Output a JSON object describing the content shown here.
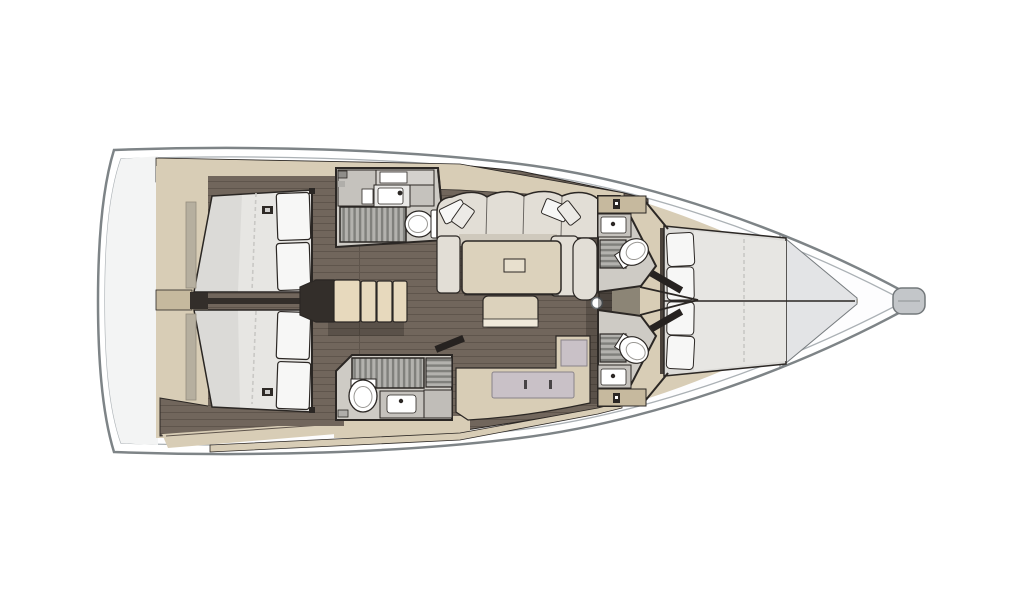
{
  "meta": {
    "title": "Sailing yacht interior layout plan, top view, bow to the right",
    "orientation": "bow-right"
  },
  "colors": {
    "page-bg": "#ffffff",
    "hull-line": "#7e8487",
    "hull-inner": "#abb1b5",
    "deck": "#fdfdfe",
    "stern": "#f3f4f4",
    "beige": "#d8cdb6",
    "beige-dark": "#c6b99e",
    "cream": "#e7d9bd",
    "wood": "#71665c",
    "wood-line": "#5f554c",
    "wall-dark": "#332e2a",
    "door-dark": "#262220",
    "outline": "#2b2724",
    "shadow": "rgba(0,0,0,0.20)",
    "mattress": "#e7e6e3",
    "mattress-edge": "#c9c8c5",
    "pillow": "#f7f7f6",
    "sofa": "#e2ded6",
    "sofa-shade": "#cfc9bd",
    "table": "#dcd2bc",
    "fixture-floor": "#cecbc5",
    "counter": "#c5c2bd",
    "grate": "#b3b2ae",
    "grate-slat": "#80807c",
    "white": "#ffffff",
    "mauve": "#c9c1c7",
    "bow-wedge": "#e3e4e6",
    "metal": "#c3c6c9"
  },
  "vessel": {
    "rooms": [
      {
        "id": "stern-locker",
        "fixtures": []
      },
      {
        "id": "aft-cabin-port",
        "fixtures": [
          "double-berth",
          "pillow",
          "pillow",
          "hanging-locker",
          "reading-light",
          "wardrobe"
        ]
      },
      {
        "id": "aft-cabin-starboard",
        "fixtures": [
          "double-berth",
          "pillow",
          "pillow",
          "hanging-locker",
          "reading-light",
          "wardrobe"
        ]
      },
      {
        "id": "head-aft-port",
        "fixtures": [
          "vanity-counter",
          "washbasin",
          "shower-grating",
          "toilet"
        ]
      },
      {
        "id": "head-aft-starboard",
        "fixtures": [
          "shower-grating",
          "toilet",
          "washbasin",
          "locker"
        ]
      },
      {
        "id": "companionway",
        "fixtures": [
          "landing",
          "step",
          "step",
          "step",
          "step"
        ]
      },
      {
        "id": "salon",
        "fixtures": [
          "u-sofa",
          "throw-pillow",
          "throw-pillow",
          "throw-pillow",
          "throw-pillow",
          "saloon-table",
          "table-hatch",
          "ottoman",
          "sideboard"
        ]
      },
      {
        "id": "mast-post",
        "fixtures": []
      },
      {
        "id": "head-forward-port",
        "fixtures": [
          "cabinet",
          "washbasin",
          "shower-grating",
          "toilet"
        ]
      },
      {
        "id": "head-forward-starboard",
        "fixtures": [
          "cabinet",
          "washbasin",
          "shower-grating",
          "toilet"
        ]
      },
      {
        "id": "forward-cabin",
        "fixtures": [
          "double-berth",
          "headboard-cushions",
          "bow-platform"
        ]
      },
      {
        "id": "bow-fitting",
        "fixtures": []
      }
    ]
  }
}
